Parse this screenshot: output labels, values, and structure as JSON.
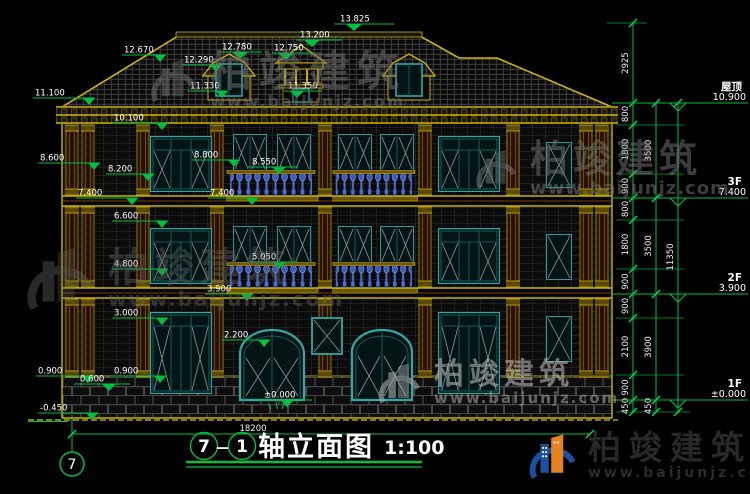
{
  "drawing": {
    "marks": {
      "ridge": "13.825",
      "cupola_top": "13.200",
      "cupola_eave": "12.750",
      "cupola_base": "11.350",
      "dormer_top": "12.780",
      "dormer_eave": "12.290",
      "dormer_base": "11.330",
      "roof_slope": "12.670",
      "eave_top": "11.100",
      "eave_bottom": "10.100",
      "col_capital": "8.600",
      "band3": "8.200",
      "cornice3": "8.800",
      "rail3": "8.550",
      "floor3_left": "7.400",
      "floor3_center": "7.400",
      "win2_top": "6.600",
      "rail2": "5.050",
      "band2": "4.800",
      "floor2": "3.900",
      "sill2": "3.000",
      "door_top": "2.200",
      "pedestal_left": "0.900",
      "pedestal_center": "0.600",
      "pedestal_right": "0.900",
      "ground": "-0.450",
      "zero": "±0.000"
    },
    "levels": [
      {
        "name": "屋顶",
        "value": "10.900"
      },
      {
        "name": "3F",
        "value": "7.400"
      },
      {
        "name": "2F",
        "value": "3.900"
      },
      {
        "name": "1F",
        "value": "±0.000"
      }
    ],
    "dims": {
      "chain_inner": [
        "2925",
        "800",
        "1800",
        "900",
        "800",
        "1800",
        "900",
        "900",
        "2100",
        "900",
        "450"
      ],
      "chain_mid": [
        "3500",
        "3500",
        "3900",
        "450"
      ],
      "chain_total": "11350",
      "total_width": "18200"
    }
  },
  "footer": {
    "axis_a": "7",
    "dash": "—",
    "axis_b": "1",
    "title": "轴立面图",
    "scale": "1:100",
    "axis_bubble": "7"
  },
  "brand": {
    "name": "柏竣建筑",
    "url": "www.baijunjz.com"
  },
  "colors": {
    "dim_green": "#00c040",
    "cad_yellow": "#c8b400",
    "window_teal": "#2fa8a8",
    "baluster_blue": "#4a6fd4",
    "logo_blue": "#1d4fa0",
    "logo_orange": "#e8821e"
  }
}
